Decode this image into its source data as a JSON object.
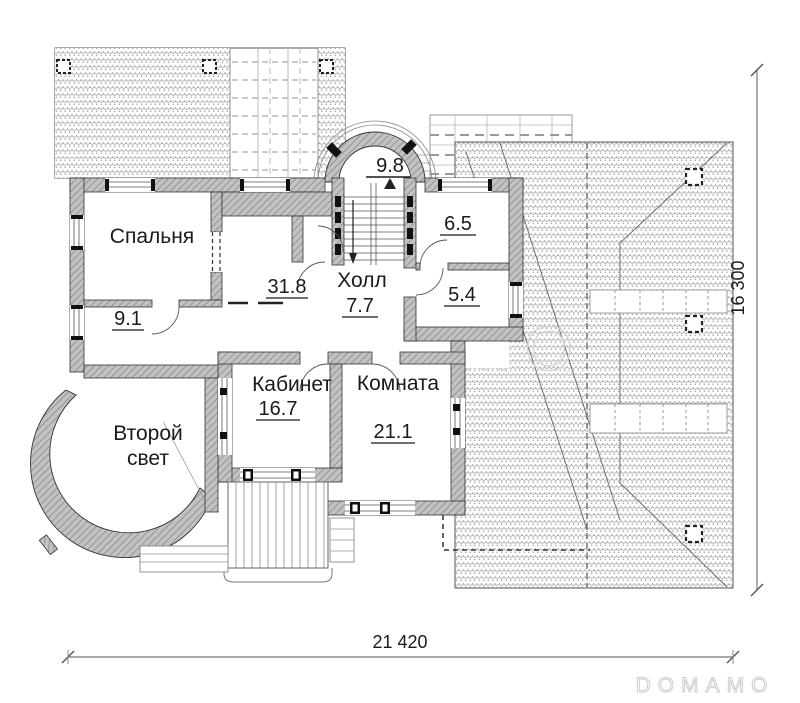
{
  "plan": {
    "rooms": {
      "bedroom": {
        "name": "Спальня"
      },
      "room_9_1": {
        "area": "9.1"
      },
      "corridor": {
        "area": "31.8"
      },
      "hall": {
        "name": "Холл",
        "area": "7.7"
      },
      "stair_balcony": {
        "area": "9.8"
      },
      "bath": {
        "area": "6.5"
      },
      "wc": {
        "area": "5.4"
      },
      "office": {
        "name": "Кабинет",
        "area": "16.7"
      },
      "room_21_1": {
        "name": "Комната",
        "area": "21.1"
      },
      "second_light": {
        "line1": "Второй",
        "line2": "свет"
      }
    },
    "dimensions": {
      "width_mm": "21 420",
      "height_mm": "16 300"
    },
    "watermark": {
      "center": "DOMAMO",
      "corner": "DOMAMO"
    },
    "colors": {
      "wall_gray": "#c2c2c2",
      "line": "#333333",
      "dim_line": "#8c8c8c",
      "watermark_gray": "#d6d6d6"
    }
  }
}
